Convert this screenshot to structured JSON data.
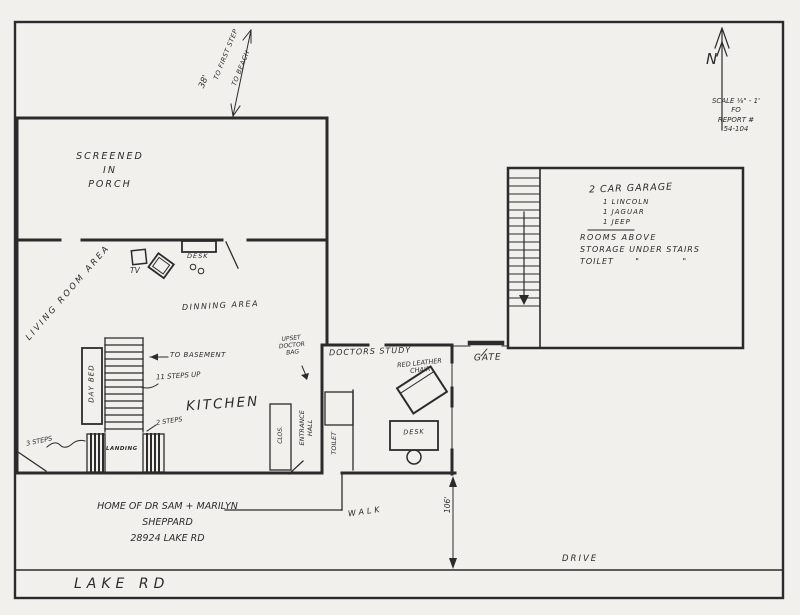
{
  "meta": {
    "paper_color": "#f1f0ed",
    "ink_color": "#2b2b2b",
    "drawing_type": "hand-drawn floor plan"
  },
  "compass": {
    "north_label": "N"
  },
  "scale_note": {
    "text": "SCALE ⅛\" - 1'\nFO\nREPORT #\n54-104"
  },
  "beach_arrow": {
    "distance": "38'",
    "line1": "TO FIRST STEP",
    "line2": "TO BEACH"
  },
  "rooms": {
    "porch": "SCREENED\nIN\nPORCH",
    "living_room": "LIVING ROOM AREA",
    "dining": "DINNING AREA",
    "kitchen": "KITCHEN",
    "study": "DOCTORS STUDY",
    "entrance_hall": "ENTRANCE\nHALL",
    "toilet": "TOILET",
    "closet": "CLOS.",
    "landing": "LANDING"
  },
  "garage": {
    "title": "2 CAR GARAGE",
    "cars": [
      "1 LINCOLN",
      "1 JAGUAR",
      "1 JEEP"
    ],
    "note1": "ROOMS ABOVE",
    "note2": "STORAGE UNDER STAIRS",
    "note3": "TOILET      \"            \""
  },
  "furniture": {
    "tv": "TV",
    "living_desk": "DESK",
    "day_bed": "DAY BED",
    "red_chair": "RED LEATHER\nCHAIR",
    "study_desk": "DESK",
    "doctor_bag": "UPSET\nDOCTOR\nBAG"
  },
  "stairs": {
    "to_basement": "TO BASEMENT",
    "eleven_up": "11 STEPS UP",
    "two_steps": "2 STEPS",
    "three_steps": "3 STEPS"
  },
  "site": {
    "gate": "GATE",
    "walk": "WALK",
    "drive": "DRIVE",
    "lake_road": "LAKE RD",
    "front_depth": "106'"
  },
  "caption": "HOME OF DR SAM + MARILYN\nSHEPPARD\n28924 LAKE RD"
}
